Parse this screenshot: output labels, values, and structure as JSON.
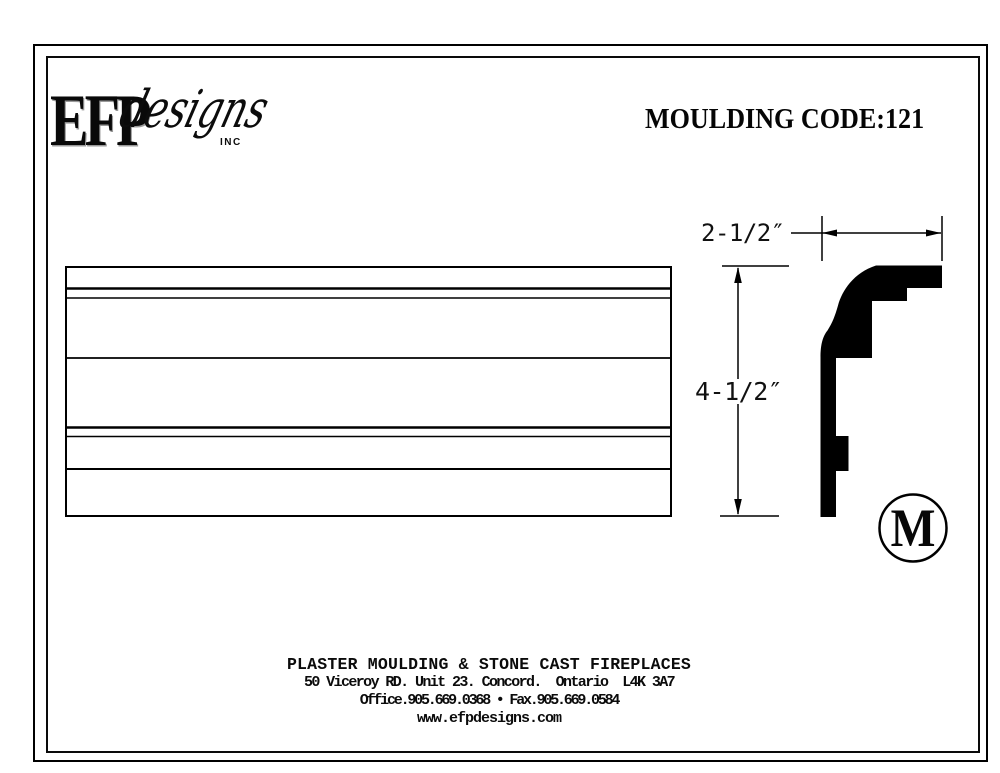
{
  "header": {
    "moulding_code": "MOULDING CODE:121"
  },
  "logo": {
    "efp": "EFP",
    "designs": "designs",
    "inc": "INC"
  },
  "drawing": {
    "profile": {
      "width_label": "2-1/2″",
      "height_label": "4-1/2″",
      "symbol": "M"
    }
  },
  "footer": {
    "company_line": "PLASTER MOULDING & STONE CAST FIREPLACES",
    "address_line": "50 Viceroy RD. Unit 23. Concord.  Ontario  L4K 3A7",
    "phone_line": "Office.905.669.0368 • Fax.905.669.0584",
    "website": "www.efpdesigns.com"
  },
  "colors": {
    "ink": "#000000",
    "paper": "#ffffff"
  }
}
